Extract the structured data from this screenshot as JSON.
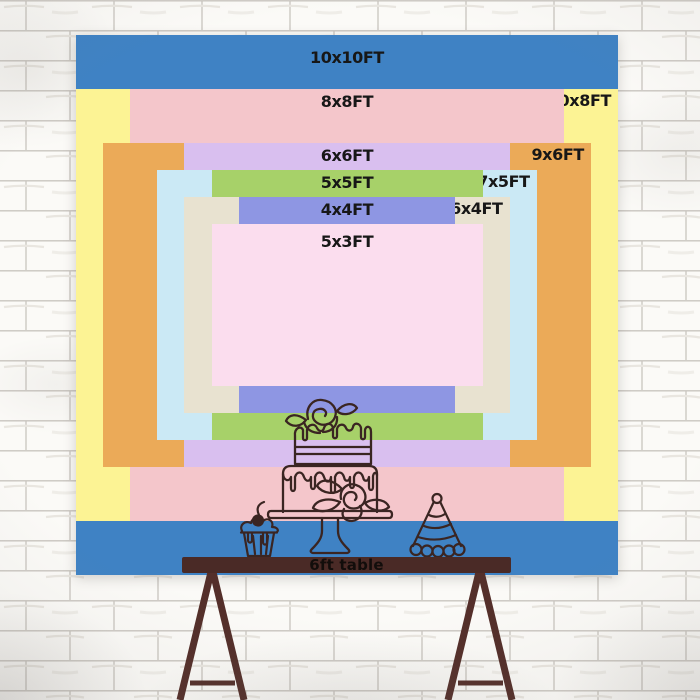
{
  "backdrop_chart": {
    "sizes": [
      {
        "label": "10x10FT",
        "width_ft": 10,
        "height_ft": 10,
        "color": "#3f82c4",
        "label_position": "top-center"
      },
      {
        "label": "10x8FT",
        "width_ft": 10,
        "height_ft": 8,
        "color": "#fcf394",
        "label_position": "top-right"
      },
      {
        "label": "8x8FT",
        "width_ft": 8,
        "height_ft": 8,
        "color": "#f4c6cb",
        "label_position": "top-center"
      },
      {
        "label": "9x6FT",
        "width_ft": 9,
        "height_ft": 6,
        "color": "#ebaa58",
        "label_position": "top-right"
      },
      {
        "label": "6x6FT",
        "width_ft": 6,
        "height_ft": 6,
        "color": "#d9bfef",
        "label_position": "top-center"
      },
      {
        "label": "7x5FT",
        "width_ft": 7,
        "height_ft": 5,
        "color": "#cbe9f5",
        "label_position": "top-right"
      },
      {
        "label": "5x5FT",
        "width_ft": 5,
        "height_ft": 5,
        "color": "#a7d169",
        "label_position": "top-center"
      },
      {
        "label": "6x4FT",
        "width_ft": 6,
        "height_ft": 4,
        "color": "#e8e2d0",
        "label_position": "top-right"
      },
      {
        "label": "4x4FT",
        "width_ft": 4,
        "height_ft": 4,
        "color": "#8e96e3",
        "label_position": "top-center"
      },
      {
        "label": "5x3FT",
        "width_ft": 5,
        "height_ft": 3,
        "color": "#fbddee",
        "label_position": "top-center"
      }
    ],
    "label_text_color": "#171717"
  },
  "table": {
    "label": "6ft table",
    "bar_color": "#4a2a26",
    "legs_color": "#542f2a",
    "label_color": "#120d0b"
  },
  "illustrations": {
    "cake": "two-tier-drip-cake-with-roses",
    "cupcake": "cupcake-with-cherry",
    "hat": "party-hat",
    "line_color": "#3a2522"
  },
  "wall": {
    "brick_color": "#fbfaf7",
    "mortar_color": "#c9c5bf"
  }
}
